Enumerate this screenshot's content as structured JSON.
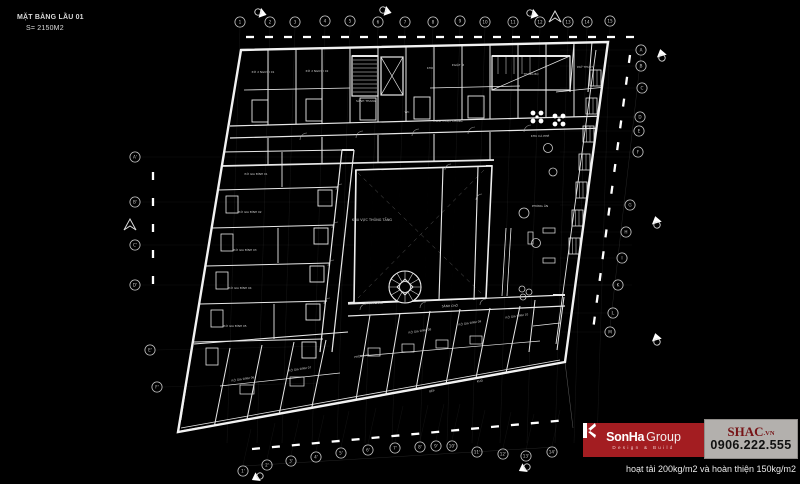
{
  "title": {
    "line1": "MẶT BẰNG LẦU 01",
    "line2": "S= 2150M2"
  },
  "note": "hoạt tải 200kg/m2 và hoàn thiện 150kg/m2",
  "logo": {
    "brand_bold": "SonHa",
    "brand_light": "Group",
    "tagline": "Design & Build",
    "site_name": "SHAC",
    "site_tld": ".VN",
    "phone": "0906.222.555",
    "colors": {
      "red": "#a31d21",
      "panel": "#b3b0ad",
      "site_text": "#771417",
      "phone_text": "#101010"
    }
  },
  "plan": {
    "line_color": "#e8e8e8",
    "grids": {
      "top": {
        "labels": [
          "1",
          "2",
          "3",
          "4",
          "5",
          "6",
          "7",
          "8",
          "9",
          "10",
          "11",
          "12",
          "13",
          "14",
          "15"
        ],
        "points": [
          [
            240,
            22
          ],
          [
            270,
            22
          ],
          [
            295,
            22
          ],
          [
            325,
            21
          ],
          [
            350,
            21
          ],
          [
            378,
            22
          ],
          [
            405,
            22
          ],
          [
            433,
            22
          ],
          [
            460,
            21
          ],
          [
            485,
            22
          ],
          [
            513,
            22
          ],
          [
            540,
            22
          ],
          [
            568,
            22
          ],
          [
            587,
            22
          ],
          [
            610,
            21
          ]
        ]
      },
      "right": {
        "labels": [
          "A",
          "B",
          "C",
          "D",
          "E",
          "F",
          "G",
          "H",
          "I",
          "K",
          "L",
          "M"
        ],
        "points": [
          [
            641,
            50
          ],
          [
            641,
            66
          ],
          [
            642,
            88
          ],
          [
            640,
            117
          ],
          [
            639,
            131
          ],
          [
            638,
            152
          ],
          [
            630,
            205
          ],
          [
            626,
            232
          ],
          [
            622,
            258
          ],
          [
            618,
            285
          ],
          [
            613,
            313
          ],
          [
            610,
            332
          ]
        ]
      },
      "left": {
        "labels": [
          "A'",
          "B'",
          "C'",
          "D'",
          "E'",
          "F'"
        ],
        "points": [
          [
            135,
            157
          ],
          [
            135,
            202
          ],
          [
            135,
            245
          ],
          [
            135,
            285
          ],
          [
            150,
            350
          ],
          [
            157,
            387
          ]
        ]
      },
      "bottom": {
        "labels": [
          "1'",
          "2'",
          "3'",
          "4'",
          "5'",
          "6'",
          "7'",
          "8'",
          "9'",
          "10'",
          "11'",
          "12'",
          "13'",
          "14'"
        ],
        "points": [
          [
            243,
            471
          ],
          [
            267,
            465
          ],
          [
            291,
            461
          ],
          [
            316,
            457
          ],
          [
            341,
            453
          ],
          [
            368,
            450
          ],
          [
            395,
            448
          ],
          [
            420,
            447
          ],
          [
            436,
            446
          ],
          [
            452,
            446
          ],
          [
            477,
            452
          ],
          [
            503,
            454
          ],
          [
            526,
            456
          ],
          [
            552,
            452
          ]
        ]
      }
    },
    "flags": [
      [
        258,
        12,
        25
      ],
      [
        383,
        10,
        25
      ],
      [
        530,
        13,
        25
      ],
      [
        662,
        58,
        -95
      ],
      [
        657,
        225,
        -95
      ],
      [
        657,
        342,
        -95
      ],
      [
        260,
        476,
        160
      ],
      [
        527,
        467,
        160
      ]
    ],
    "north_marks": [
      [
        130,
        225
      ],
      [
        555,
        17
      ]
    ],
    "area_labels": [
      {
        "t": "KHU VỰC THÔNG TẦNG",
        "x": 372,
        "y": 221,
        "s": 3.4,
        "r": 0
      },
      {
        "t": "HÀNH LANG",
        "x": 374,
        "y": 304,
        "s": 3,
        "r": -2
      },
      {
        "t": "SẢNH CHỜ",
        "x": 450,
        "y": 307,
        "s": 3,
        "r": -2
      },
      {
        "t": "SẢNH THANG",
        "x": 366,
        "y": 102,
        "s": 3,
        "r": 0
      },
      {
        "t": "WC",
        "x": 407,
        "y": 113,
        "s": 2.8,
        "r": 0
      },
      {
        "t": "KHO",
        "x": 430,
        "y": 69,
        "s": 2.8,
        "r": 0
      },
      {
        "t": "P.GIẶT ỦI",
        "x": 458,
        "y": 66,
        "s": 2.8,
        "r": 0
      },
      {
        "t": "THANG BỘ",
        "x": 531,
        "y": 75,
        "s": 2.8,
        "r": 0
      },
      {
        "t": "P.KỸ THUẬT",
        "x": 585,
        "y": 68,
        "s": 2.8,
        "r": 0
      },
      {
        "t": "P.Ở 2 NGƯỜI 01",
        "x": 263,
        "y": 73,
        "s": 2.8,
        "r": 0
      },
      {
        "t": "P.Ở 2 NGƯỜI 02",
        "x": 317,
        "y": 72,
        "s": 2.8,
        "r": 0
      },
      {
        "t": "P.SINH HOẠT CHUNG",
        "x": 448,
        "y": 122,
        "s": 2.8,
        "r": 0
      },
      {
        "t": "KHU CÀ PHÊ",
        "x": 540,
        "y": 137,
        "s": 3,
        "r": 0
      },
      {
        "t": "PHÒNG ĂN",
        "x": 540,
        "y": 207,
        "s": 3,
        "r": 0
      },
      {
        "t": "P.Ở GIA ĐÌNH 01",
        "x": 256,
        "y": 175,
        "s": 2.8,
        "r": 0
      },
      {
        "t": "P.Ở GIA ĐÌNH 02",
        "x": 250,
        "y": 213,
        "s": 2.8,
        "r": 0
      },
      {
        "t": "P.Ở GIA ĐÌNH 03",
        "x": 245,
        "y": 251,
        "s": 2.8,
        "r": 0
      },
      {
        "t": "P.Ở GIA ĐÌNH 04",
        "x": 240,
        "y": 289,
        "s": 2.8,
        "r": 0
      },
      {
        "t": "P.Ở GIA ĐÌNH 05",
        "x": 235,
        "y": 327,
        "s": 2.8,
        "r": 0
      },
      {
        "t": "P.Ở GIA ĐÌNH 06",
        "x": 243,
        "y": 380,
        "s": 2.8,
        "r": -9
      },
      {
        "t": "P.Ở GIA ĐÌNH 07",
        "x": 300,
        "y": 370,
        "s": 2.8,
        "r": -9
      },
      {
        "t": "PHÒNG ĂN",
        "x": 362,
        "y": 357,
        "s": 2.8,
        "r": -9
      },
      {
        "t": "P.Ở GIA ĐÌNH 08",
        "x": 420,
        "y": 332,
        "s": 2.8,
        "r": -9
      },
      {
        "t": "P.Ở GIA ĐÌNH 09",
        "x": 470,
        "y": 324,
        "s": 2.8,
        "r": -9
      },
      {
        "t": "P.Ở GIA ĐÌNH 10",
        "x": 517,
        "y": 317,
        "s": 2.8,
        "r": -9
      },
      {
        "t": "BẾP",
        "x": 432,
        "y": 392,
        "s": 2.8,
        "r": -9
      },
      {
        "t": "KHO",
        "x": 480,
        "y": 382,
        "s": 2.8,
        "r": -9
      }
    ]
  }
}
